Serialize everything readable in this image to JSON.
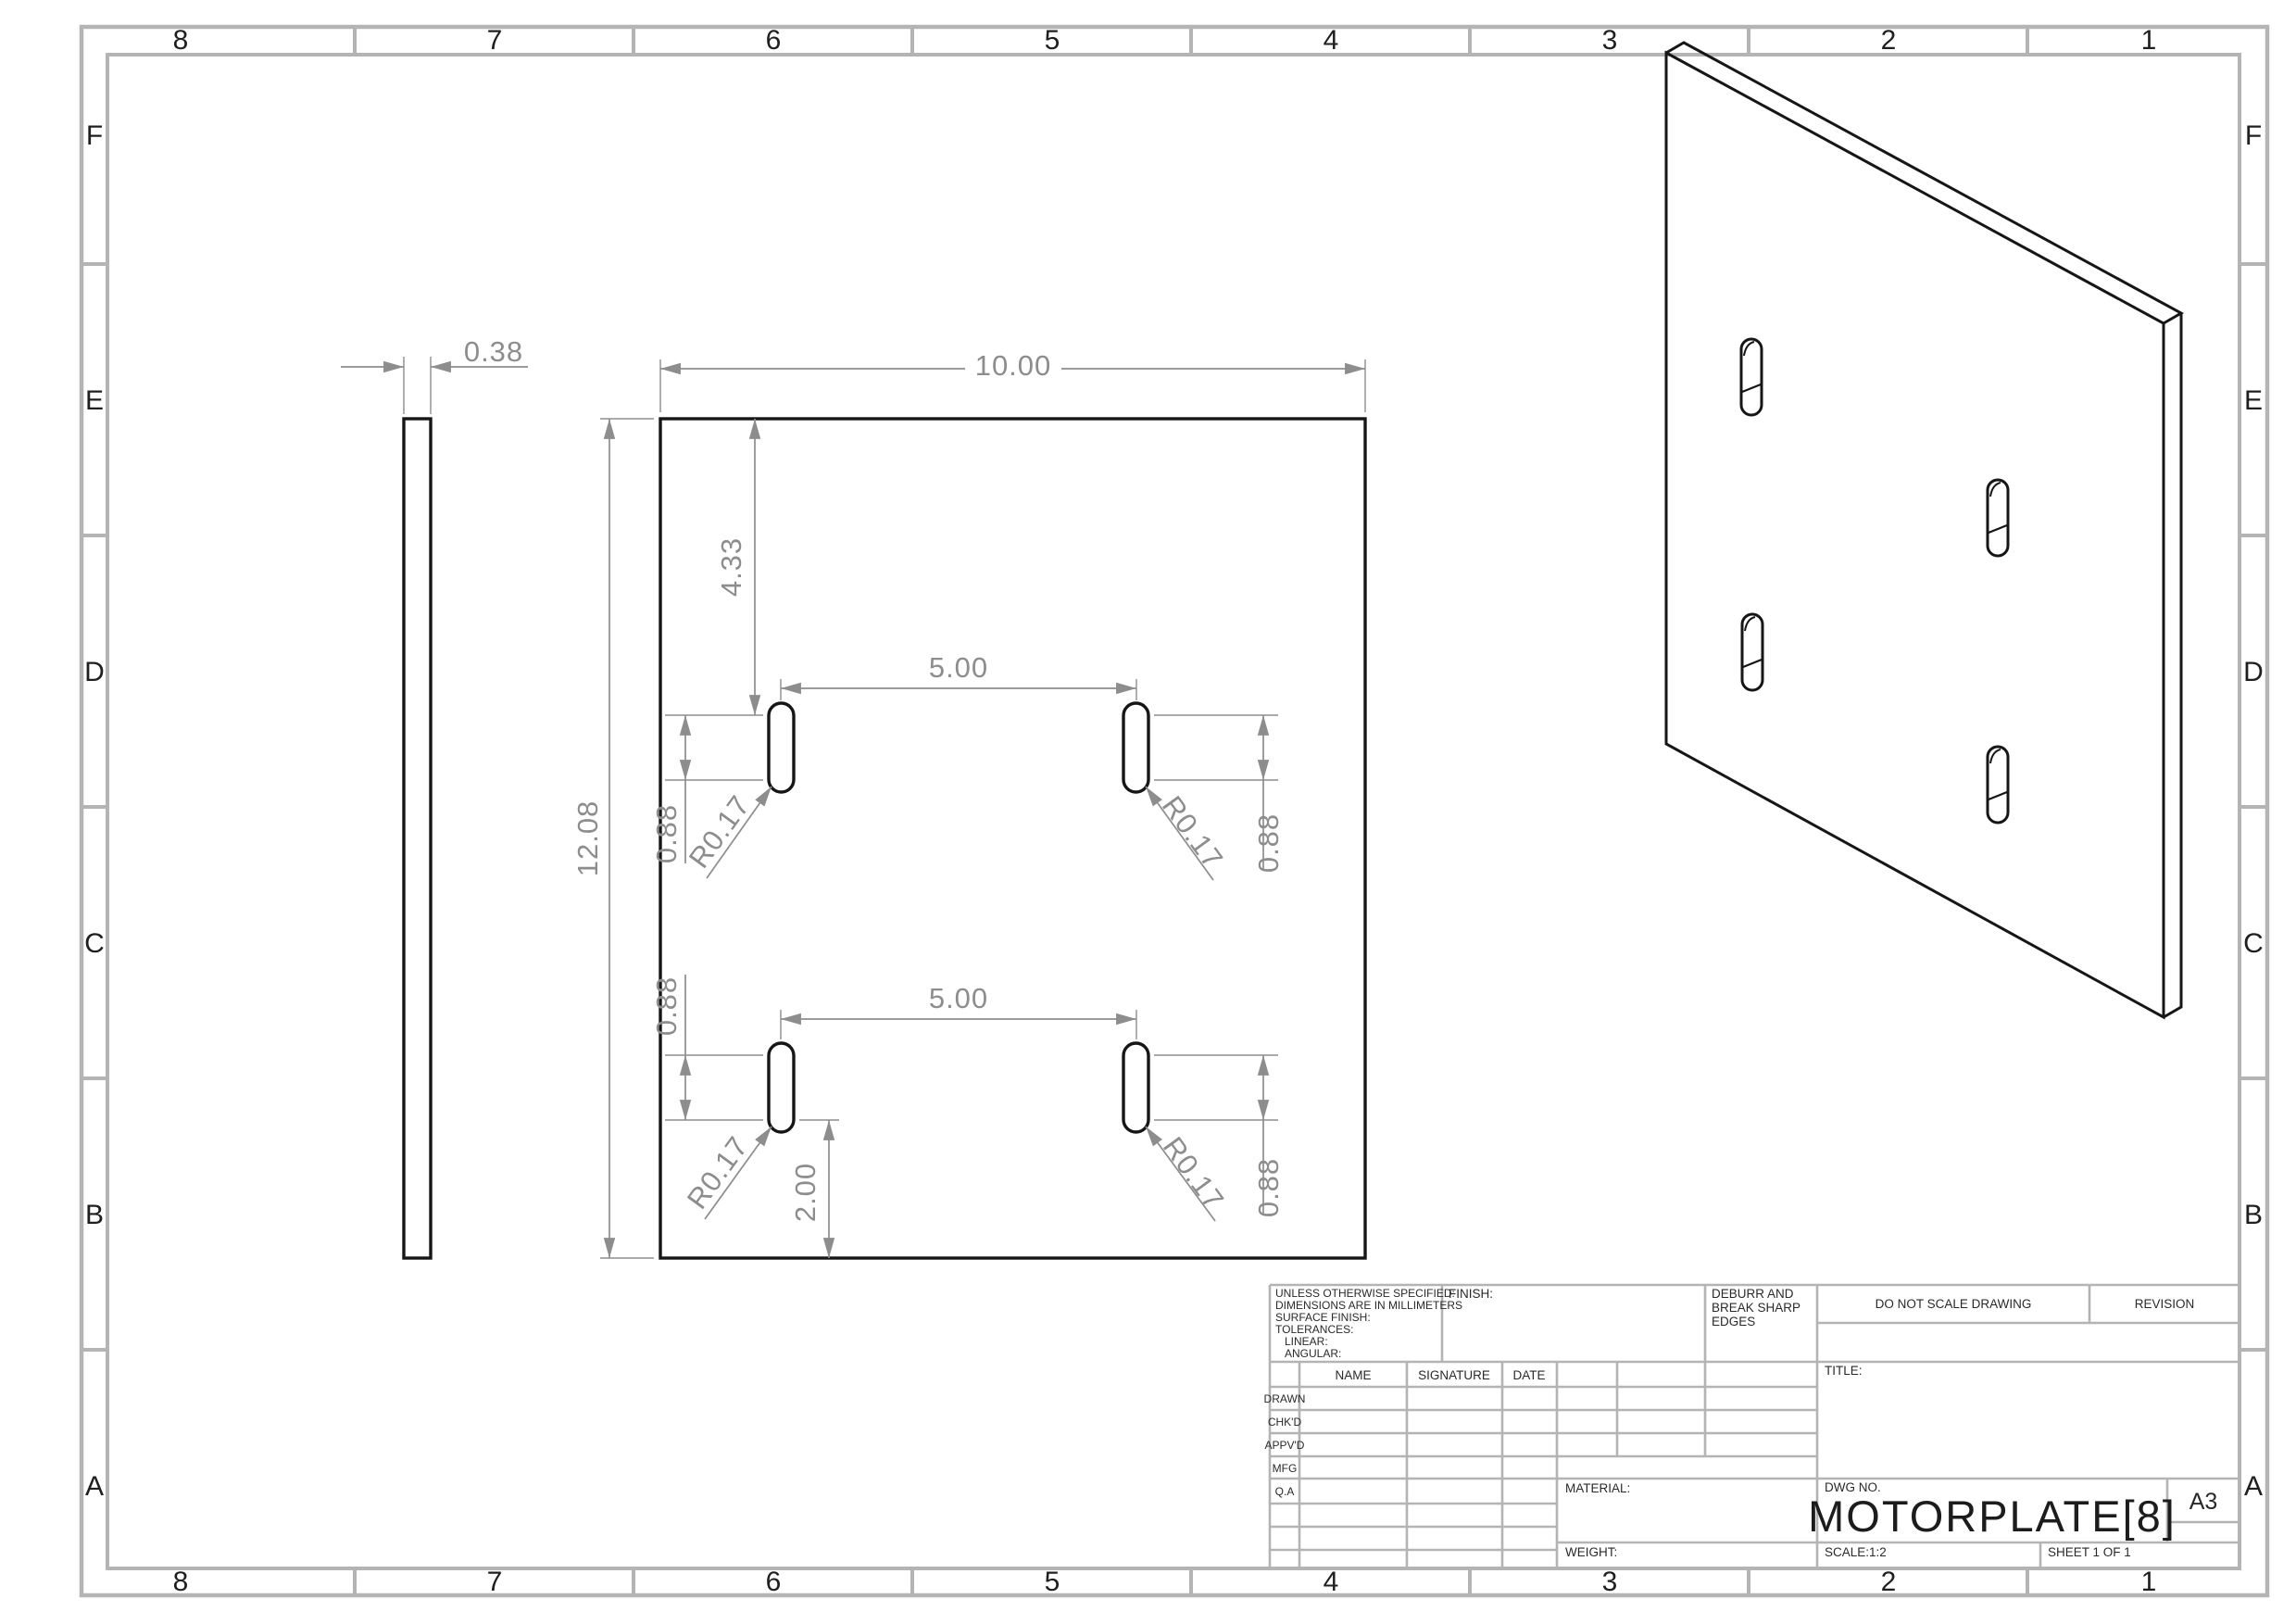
{
  "sheet": {
    "zone_columns": [
      "8",
      "7",
      "6",
      "5",
      "4",
      "3",
      "2",
      "1"
    ],
    "zone_rows": [
      "F",
      "E",
      "D",
      "C",
      "B",
      "A"
    ]
  },
  "dims": {
    "thickness": "0.38",
    "width": "10.00",
    "height": "12.08",
    "top_offset": "4.33",
    "slot_pitch_top": "5.00",
    "slot_pitch_bottom": "5.00",
    "slot_len_ul": "0.88",
    "slot_len_ur": "0.88",
    "slot_len_ll": "0.88",
    "slot_len_lr": "0.88",
    "rad_ul": "R0.17",
    "rad_ur": "R0.17",
    "rad_ll": "R0.17",
    "rad_lr": "R0.17",
    "bottom_offset": "2.00"
  },
  "title_block": {
    "tolerance_note_1": "UNLESS OTHERWISE SPECIFIED:",
    "tolerance_note_2": "DIMENSIONS ARE IN MILLIMETERS",
    "tolerance_note_3": "SURFACE FINISH:",
    "tolerance_note_4": "TOLERANCES:",
    "tolerance_note_5": "LINEAR:",
    "tolerance_note_6": "ANGULAR:",
    "finish_label": "FINISH:",
    "deburr_1": "DEBURR AND",
    "deburr_2": "BREAK SHARP",
    "deburr_3": "EDGES",
    "do_not_scale": "DO NOT SCALE DRAWING",
    "revision_label": "REVISION",
    "col_name": "NAME",
    "col_signature": "SIGNATURE",
    "col_date": "DATE",
    "row_drawn": "DRAWN",
    "row_chkd": "CHK'D",
    "row_appvd": "APPV'D",
    "row_mfg": "MFG",
    "row_qa": "Q.A",
    "title_label": "TITLE:",
    "material_label": "MATERIAL:",
    "weight_label": "WEIGHT:",
    "dwg_no_label": "DWG NO.",
    "dwg_no": "MOTORPLATE[8]",
    "paper_size": "A3",
    "scale_label": "SCALE:1:2",
    "sheet_label": "SHEET 1 OF 1"
  }
}
